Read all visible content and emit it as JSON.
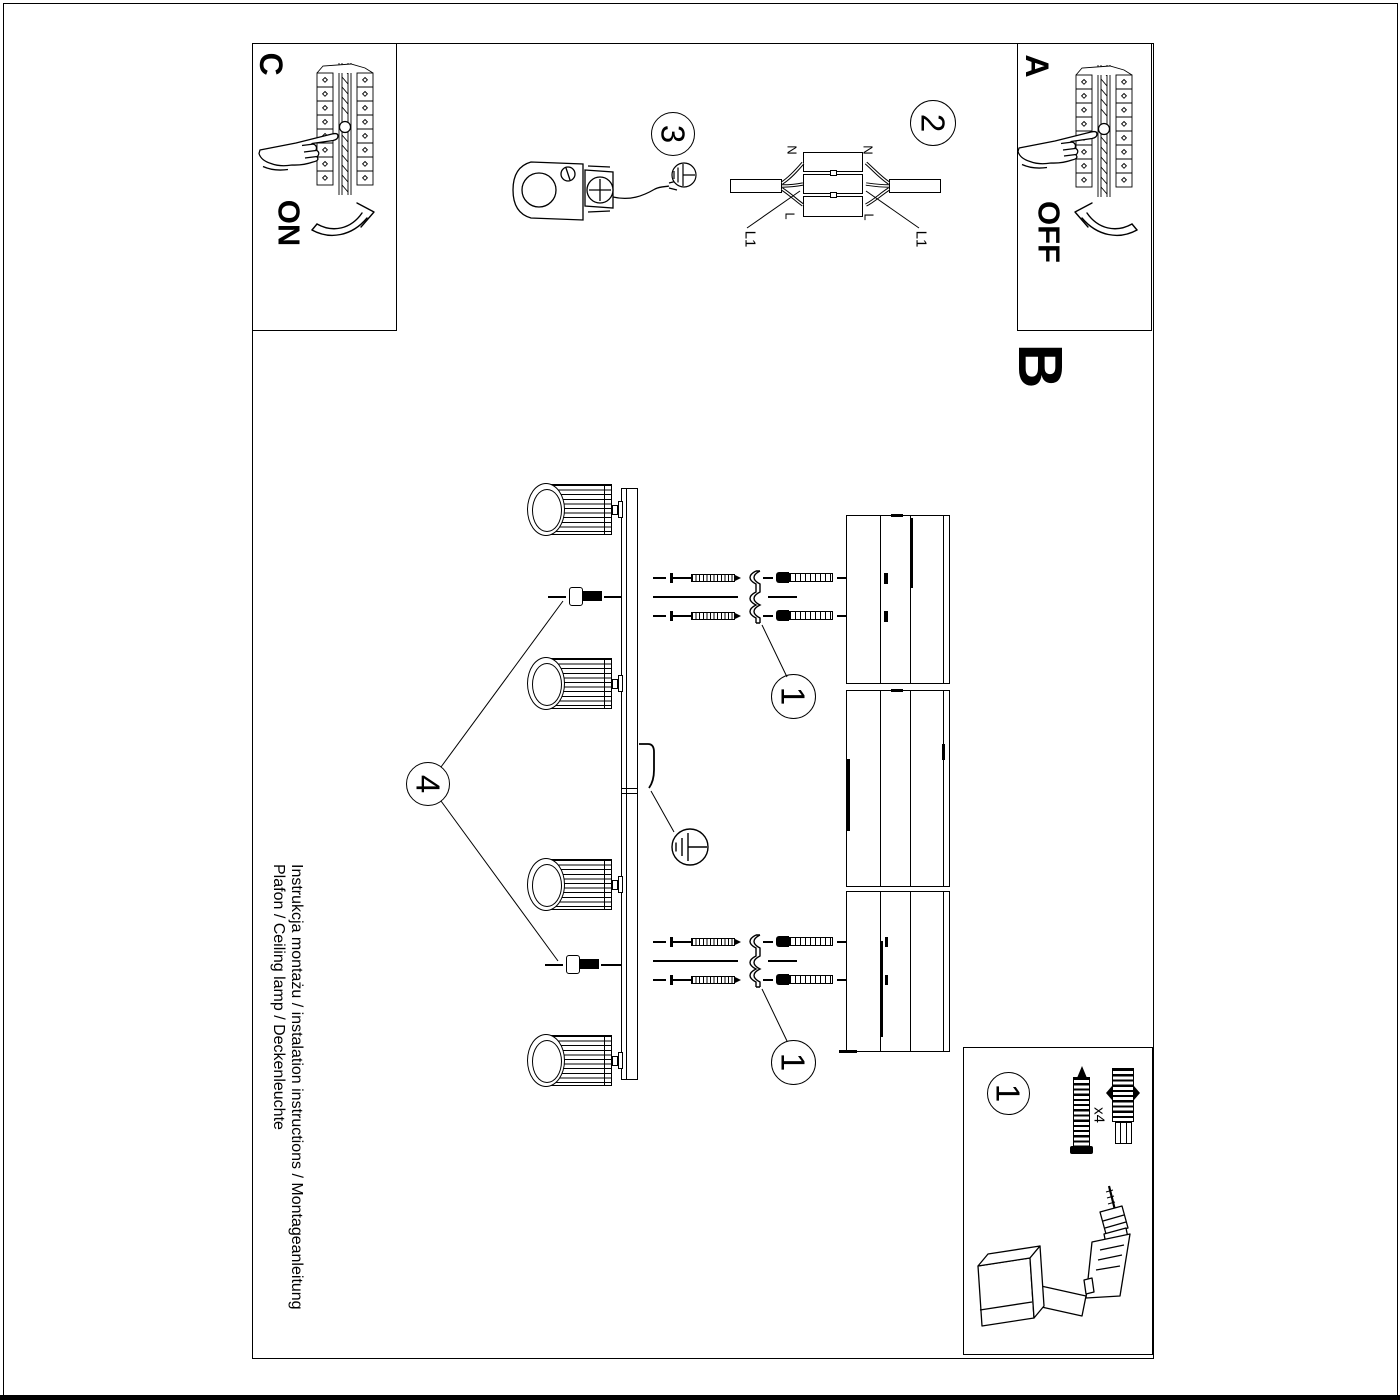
{
  "steps": {
    "a": "A",
    "b": "B",
    "c": "C",
    "step1": "1",
    "step2": "2",
    "step3": "3",
    "step4": "4"
  },
  "switch": {
    "on": "ON",
    "off": "OFF"
  },
  "wiring": {
    "neutral": "N",
    "line": "L",
    "l1": "L1"
  },
  "parts": {
    "quantity": "x4"
  },
  "footer": {
    "line1": "Instrukcja montażu / instalation instructions / Montageanleitung",
    "line2": "Plafon / Ceiling lamp / Deckenleuchte"
  }
}
